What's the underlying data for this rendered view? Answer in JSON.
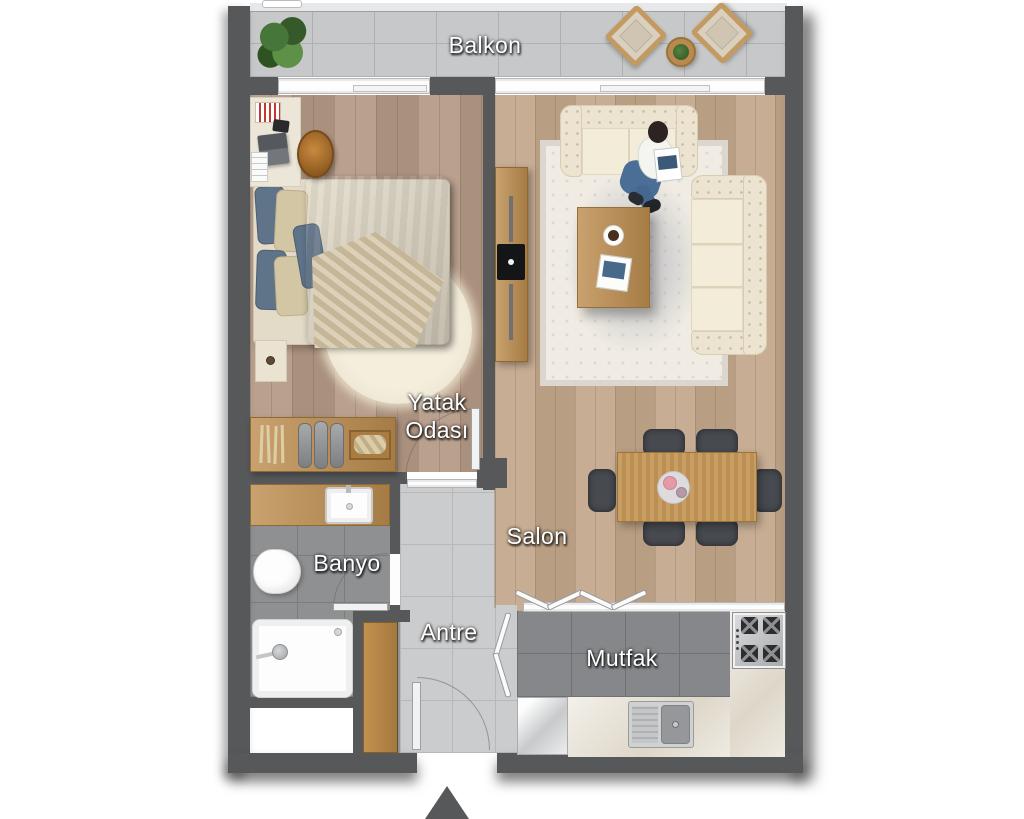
{
  "page": {
    "title": "Kat Planı - 1+1 Daire"
  },
  "rooms": {
    "balkon": {
      "label": "Balkon"
    },
    "yatak_odasi": {
      "line1": "Yatak",
      "line2": "Odası"
    },
    "salon": {
      "label": "Salon"
    },
    "banyo": {
      "label": "Banyo"
    },
    "antre": {
      "label": "Antre"
    },
    "mutfak": {
      "label": "Mutfak"
    }
  },
  "colors": {
    "wall": "#57585a",
    "wood_bedroom": "#b59a86",
    "wood_salon": "#c2a68a",
    "tile_light": "#cbcccd",
    "tile_bath": "#8e9092",
    "tile_kitchen": "#85878a",
    "tile_balcony": "#c6c8ca",
    "furniture_wood": "#bd8d4f",
    "sofa_cream": "#ece4d0",
    "dining_chair": "#474a50",
    "bed_duvet_blue": "#64788e",
    "blanket_beige": "#d2c4a4",
    "label_text": "#ffffff"
  }
}
